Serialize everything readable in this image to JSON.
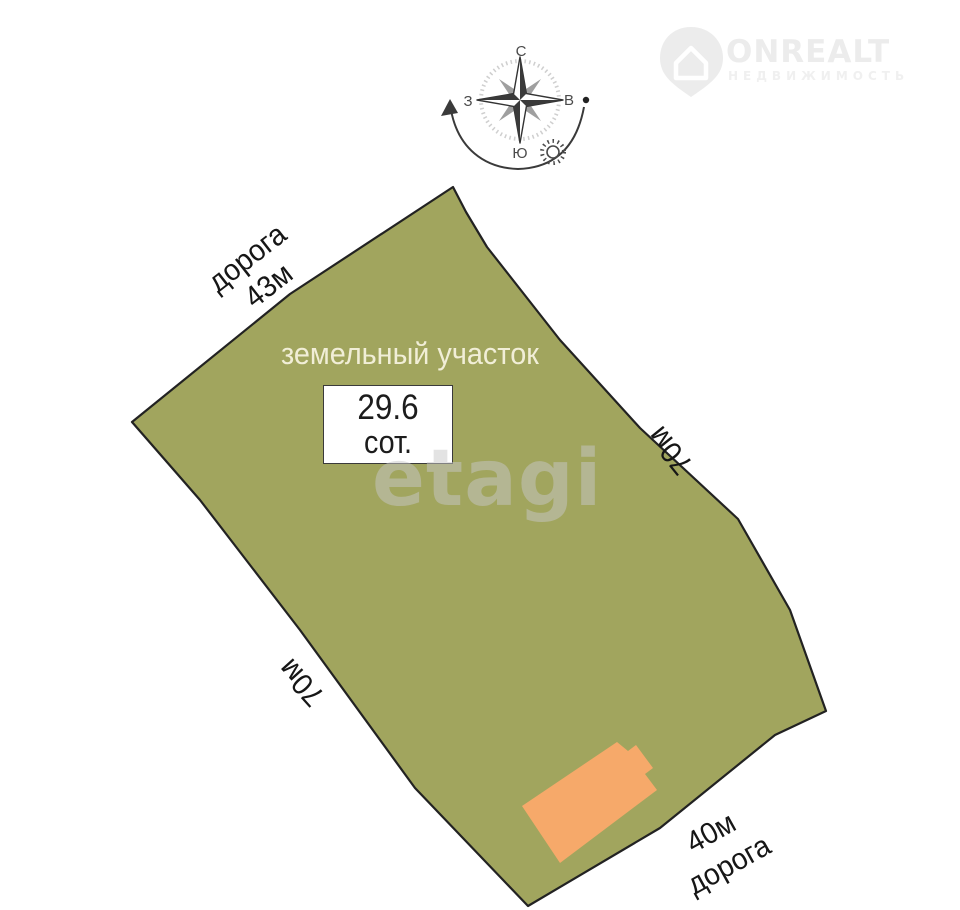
{
  "brand": {
    "name": "ONREALT",
    "subtitle": "НЕДВИЖИМОСТЬ"
  },
  "compass": {
    "north": "С",
    "south": "Ю",
    "west": "З",
    "east": "В"
  },
  "plot": {
    "title": "земельный участок",
    "area_value": "29.6",
    "area_unit": "сот.",
    "side_top": {
      "road": "дорога",
      "length": "43м"
    },
    "side_right": "70м",
    "side_left": "70м",
    "side_bottom": {
      "length": "40м",
      "road": "дорога"
    },
    "colors": {
      "land": "#a1a55e",
      "outline": "#222222",
      "building": "#f6a96a",
      "title_text": "#f1eed7"
    }
  },
  "watermark": "etagi"
}
